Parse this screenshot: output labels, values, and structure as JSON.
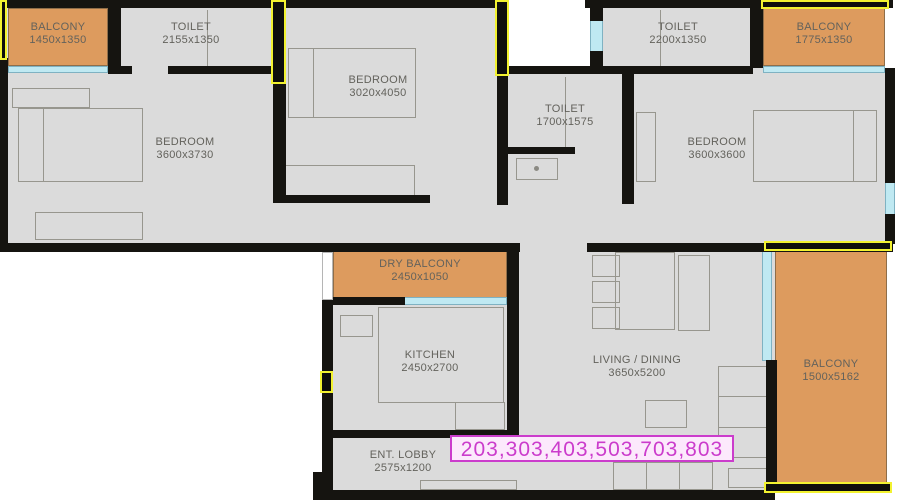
{
  "badge": {
    "units": "203,303,403,503,703,803"
  },
  "rooms": [
    {
      "id": "balcony-top-left",
      "name": "BALCONY",
      "dims": "1450x1350"
    },
    {
      "id": "toilet-top-left",
      "name": "TOILET",
      "dims": "2155x1350"
    },
    {
      "id": "bedroom-top",
      "name": "BEDROOM",
      "dims": "3020x4050"
    },
    {
      "id": "toilet-middle",
      "name": "TOILET",
      "dims": "1700x1575"
    },
    {
      "id": "toilet-top-right",
      "name": "TOILET",
      "dims": "2200x1350"
    },
    {
      "id": "balcony-top-right",
      "name": "BALCONY",
      "dims": "1775x1350"
    },
    {
      "id": "bedroom-left",
      "name": "BEDROOM",
      "dims": "3600x3730"
    },
    {
      "id": "bedroom-right",
      "name": "BEDROOM",
      "dims": "3600x3600"
    },
    {
      "id": "dry-balcony",
      "name": "DRY BALCONY",
      "dims": "2450x1050"
    },
    {
      "id": "kitchen",
      "name": "KITCHEN",
      "dims": "2450x2700"
    },
    {
      "id": "living-dining",
      "name": "LIVING / DINING",
      "dims": "3650x5200"
    },
    {
      "id": "balcony-right",
      "name": "BALCONY",
      "dims": "1500x5162"
    },
    {
      "id": "ent-lobby",
      "name": "ENT. LOBBY",
      "dims": "2575x1200"
    }
  ],
  "colors": {
    "balcony": "#dd9b5e",
    "floor": "#dbdbdb",
    "wall": "#151410",
    "window": "#bfe9f2",
    "door": "#f2f230",
    "badge": "#cb3ccc"
  }
}
